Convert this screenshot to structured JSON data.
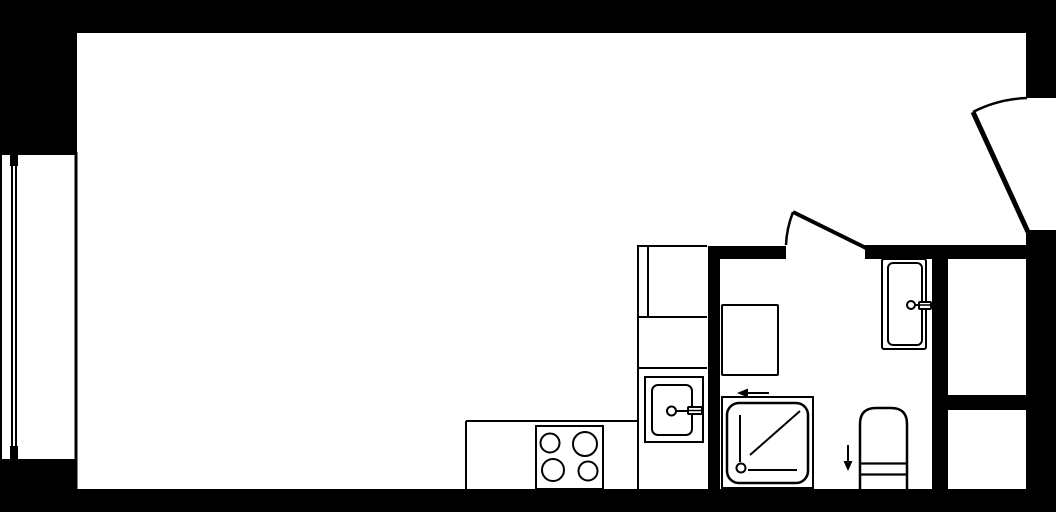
{
  "plan": {
    "type": "floor-plan",
    "width": 1056,
    "height": 512,
    "colors": {
      "background": "#ffffff",
      "ink": "#000000"
    },
    "rooms": [
      {
        "name": "main-room",
        "x": 77,
        "y": 33,
        "w": 949,
        "h": 456
      },
      {
        "name": "bathroom",
        "x": 720,
        "y": 259,
        "w": 212,
        "h": 230
      },
      {
        "name": "kitchen-strip",
        "x": 466,
        "y": 245,
        "w": 242,
        "h": 244
      },
      {
        "name": "storage-room-upper",
        "x": 948,
        "y": 258,
        "w": 78,
        "h": 137
      },
      {
        "name": "storage-room-lower",
        "x": 948,
        "y": 410,
        "w": 78,
        "h": 79
      }
    ],
    "walls": [
      {
        "name": "top-wall",
        "x": 0,
        "y": 0,
        "w": 1056,
        "h": 33
      },
      {
        "name": "left-wall-upper",
        "x": 0,
        "y": 0,
        "w": 77,
        "h": 155
      },
      {
        "name": "left-wall-lower",
        "x": 0,
        "y": 459,
        "w": 77,
        "h": 53
      },
      {
        "name": "bottom-wall",
        "x": 75,
        "y": 489,
        "w": 981,
        "h": 23
      },
      {
        "name": "right-wall-above-entry-door",
        "x": 1026,
        "y": 0,
        "w": 30,
        "h": 98
      },
      {
        "name": "right-wall-below-entry-door",
        "x": 1026,
        "y": 230,
        "w": 30,
        "h": 282
      },
      {
        "name": "bathroom-entry-wall",
        "x": 708,
        "y": 246,
        "w": 78,
        "h": 13
      },
      {
        "name": "kitchen-bathroom-partition",
        "x": 708,
        "y": 246,
        "w": 12,
        "h": 243
      },
      {
        "name": "bathroom-top-wall",
        "x": 865,
        "y": 245,
        "w": 161,
        "h": 14
      },
      {
        "name": "bathroom-storage-partition",
        "x": 932,
        "y": 246,
        "w": 16,
        "h": 243
      },
      {
        "name": "storage-rooms-divider",
        "x": 947,
        "y": 395,
        "w": 79,
        "h": 15
      },
      {
        "name": "window-mullion-top",
        "x": 10,
        "y": 150,
        "w": 8,
        "h": 16
      },
      {
        "name": "window-mullion-bottom",
        "x": 10,
        "y": 446,
        "w": 8,
        "h": 16
      }
    ],
    "outline_shapes": [
      {
        "name": "stove",
        "x": 536,
        "y": 426,
        "w": 67,
        "h": 63,
        "rx": 0,
        "sw": 2
      },
      {
        "name": "kitchen-sink-cabinet",
        "x": 645,
        "y": 377,
        "w": 58,
        "h": 65,
        "rx": 0,
        "sw": 2
      },
      {
        "name": "kitchen-sink-basin",
        "x": 652,
        "y": 385,
        "w": 40,
        "h": 50,
        "rx": 6,
        "sw": 2
      },
      {
        "name": "washing-machine",
        "x": 722,
        "y": 305,
        "w": 56,
        "h": 70,
        "rx": 1,
        "sw": 2
      },
      {
        "name": "shower-enclosure",
        "x": 722,
        "y": 397,
        "w": 91,
        "h": 91,
        "rx": 0,
        "sw": 2
      },
      {
        "name": "shower-tray",
        "x": 727,
        "y": 403,
        "w": 81,
        "h": 80,
        "rx": 12,
        "sw": 2.5
      },
      {
        "name": "bathroom-sink",
        "x": 882,
        "y": 259,
        "w": 44,
        "h": 90,
        "rx": 2,
        "sw": 2
      },
      {
        "name": "bathroom-sink-basin",
        "x": 888,
        "y": 263,
        "w": 34,
        "h": 82,
        "rx": 5,
        "sw": 2
      },
      {
        "name": "kitchen-faucet-handle",
        "x": 688,
        "y": 407,
        "w": 14,
        "h": 7,
        "rx": 1,
        "sw": 2
      },
      {
        "name": "bathroom-faucet-handle",
        "x": 919,
        "y": 302,
        "w": 12,
        "h": 7,
        "rx": 1,
        "sw": 2
      }
    ],
    "paths": [
      {
        "name": "toilet-body",
        "d": "M 860 489 L 860 424 Q 860 408 876 408 L 891 408 Q 907 408 907 424 L 907 489",
        "sw": 2.5,
        "fill": "background"
      },
      {
        "name": "entry-door-arc",
        "d": "M 973 112 Q 998 99 1027 98",
        "sw": 2.5,
        "fill": "none"
      },
      {
        "name": "bathroom-door-arc",
        "d": "M 793 212 Q 786.5 229 786 245",
        "sw": 2.5,
        "fill": "none"
      }
    ],
    "circles": [
      {
        "name": "stove-burner-top-left",
        "cx": 550,
        "cy": 443,
        "r": 9.5,
        "sw": 2
      },
      {
        "name": "stove-burner-top-right",
        "cx": 585,
        "cy": 444,
        "r": 12,
        "sw": 2
      },
      {
        "name": "stove-burner-bottom-left",
        "cx": 553,
        "cy": 470,
        "r": 11,
        "sw": 2
      },
      {
        "name": "stove-burner-bottom-right",
        "cx": 588,
        "cy": 471,
        "r": 9.5,
        "sw": 2
      },
      {
        "name": "kitchen-faucet-base",
        "cx": 671.5,
        "cy": 411,
        "r": 4.5,
        "sw": 2
      },
      {
        "name": "shower-drain",
        "cx": 741,
        "cy": 468,
        "r": 4.5,
        "sw": 2
      },
      {
        "name": "bathroom-faucet-base",
        "cx": 911,
        "cy": 305,
        "r": 4,
        "sw": 2
      }
    ],
    "lines": [
      {
        "name": "window-outer-face",
        "x1": 1,
        "y1": 155,
        "x2": 1,
        "y2": 460,
        "sw": 2
      },
      {
        "name": "window-glass-line-a",
        "x1": 12,
        "y1": 160,
        "x2": 12,
        "y2": 450,
        "sw": 2
      },
      {
        "name": "window-glass-line-b",
        "x1": 16,
        "y1": 160,
        "x2": 16,
        "y2": 450,
        "sw": 2
      },
      {
        "name": "window-inner-face",
        "x1": 76,
        "y1": 152,
        "x2": 76,
        "y2": 490,
        "sw": 3
      },
      {
        "name": "counter-top-edge",
        "x1": 466,
        "y1": 421,
        "x2": 638,
        "y2": 421,
        "sw": 2
      },
      {
        "name": "counter-left-edge",
        "x1": 466,
        "y1": 421,
        "x2": 466,
        "y2": 489,
        "sw": 2
      },
      {
        "name": "cabinet-column-left-edge",
        "x1": 638,
        "y1": 245,
        "x2": 638,
        "y2": 489,
        "sw": 2
      },
      {
        "name": "cabinet-column-top-edge",
        "x1": 637,
        "y1": 246,
        "x2": 707,
        "y2": 246,
        "sw": 2
      },
      {
        "name": "tall-cabinet-face-line",
        "x1": 648,
        "y1": 246,
        "x2": 648,
        "y2": 317,
        "sw": 2
      },
      {
        "name": "cabinet-divider-upper",
        "x1": 637,
        "y1": 317,
        "x2": 707,
        "y2": 317,
        "sw": 2
      },
      {
        "name": "cabinet-divider-lower",
        "x1": 637,
        "y1": 368,
        "x2": 707,
        "y2": 368,
        "sw": 2
      },
      {
        "name": "kitchen-faucet-stem",
        "x1": 676,
        "y1": 411,
        "x2": 689,
        "y2": 411,
        "sw": 2
      },
      {
        "name": "kitchen-faucet-bar",
        "x1": 688,
        "y1": 410.5,
        "x2": 702,
        "y2": 410.5,
        "sw": 1.5
      },
      {
        "name": "bathroom-faucet-stem",
        "x1": 915,
        "y1": 305,
        "x2": 920,
        "y2": 305,
        "sw": 2
      },
      {
        "name": "bathroom-faucet-bar",
        "x1": 919,
        "y1": 305,
        "x2": 930,
        "y2": 305,
        "sw": 1.5
      },
      {
        "name": "shower-side-line",
        "x1": 740,
        "y1": 415,
        "x2": 740,
        "y2": 462,
        "sw": 2
      },
      {
        "name": "shower-diagonal-line",
        "x1": 750,
        "y1": 455,
        "x2": 800,
        "y2": 411,
        "sw": 2
      },
      {
        "name": "shower-bottom-line",
        "x1": 748,
        "y1": 470,
        "x2": 797,
        "y2": 470,
        "sw": 2
      },
      {
        "name": "toilet-seam-upper",
        "x1": 860,
        "y1": 463.5,
        "x2": 907,
        "y2": 463.5,
        "sw": 2.2
      },
      {
        "name": "toilet-seam-lower",
        "x1": 860,
        "y1": 474.5,
        "x2": 907,
        "y2": 474.5,
        "sw": 2.2
      },
      {
        "name": "shower-arrow-shaft",
        "x1": 746,
        "y1": 393,
        "x2": 769,
        "y2": 393,
        "sw": 2
      },
      {
        "name": "drain-arrow-shaft",
        "x1": 848,
        "y1": 445,
        "x2": 848,
        "y2": 463,
        "sw": 2
      },
      {
        "name": "entry-door-leaf",
        "x1": 1028,
        "y1": 232,
        "x2": 973,
        "y2": 112,
        "sw": 5
      },
      {
        "name": "bathroom-door-leaf",
        "x1": 866,
        "y1": 248,
        "x2": 793,
        "y2": 212,
        "sw": 4
      }
    ],
    "filled_polygons": [
      {
        "name": "shower-arrow-head",
        "points": "737,393 748,388.5 748,397.5"
      },
      {
        "name": "drain-arrow-head",
        "points": "848,471 843.5,461 852.5,461"
      }
    ]
  }
}
